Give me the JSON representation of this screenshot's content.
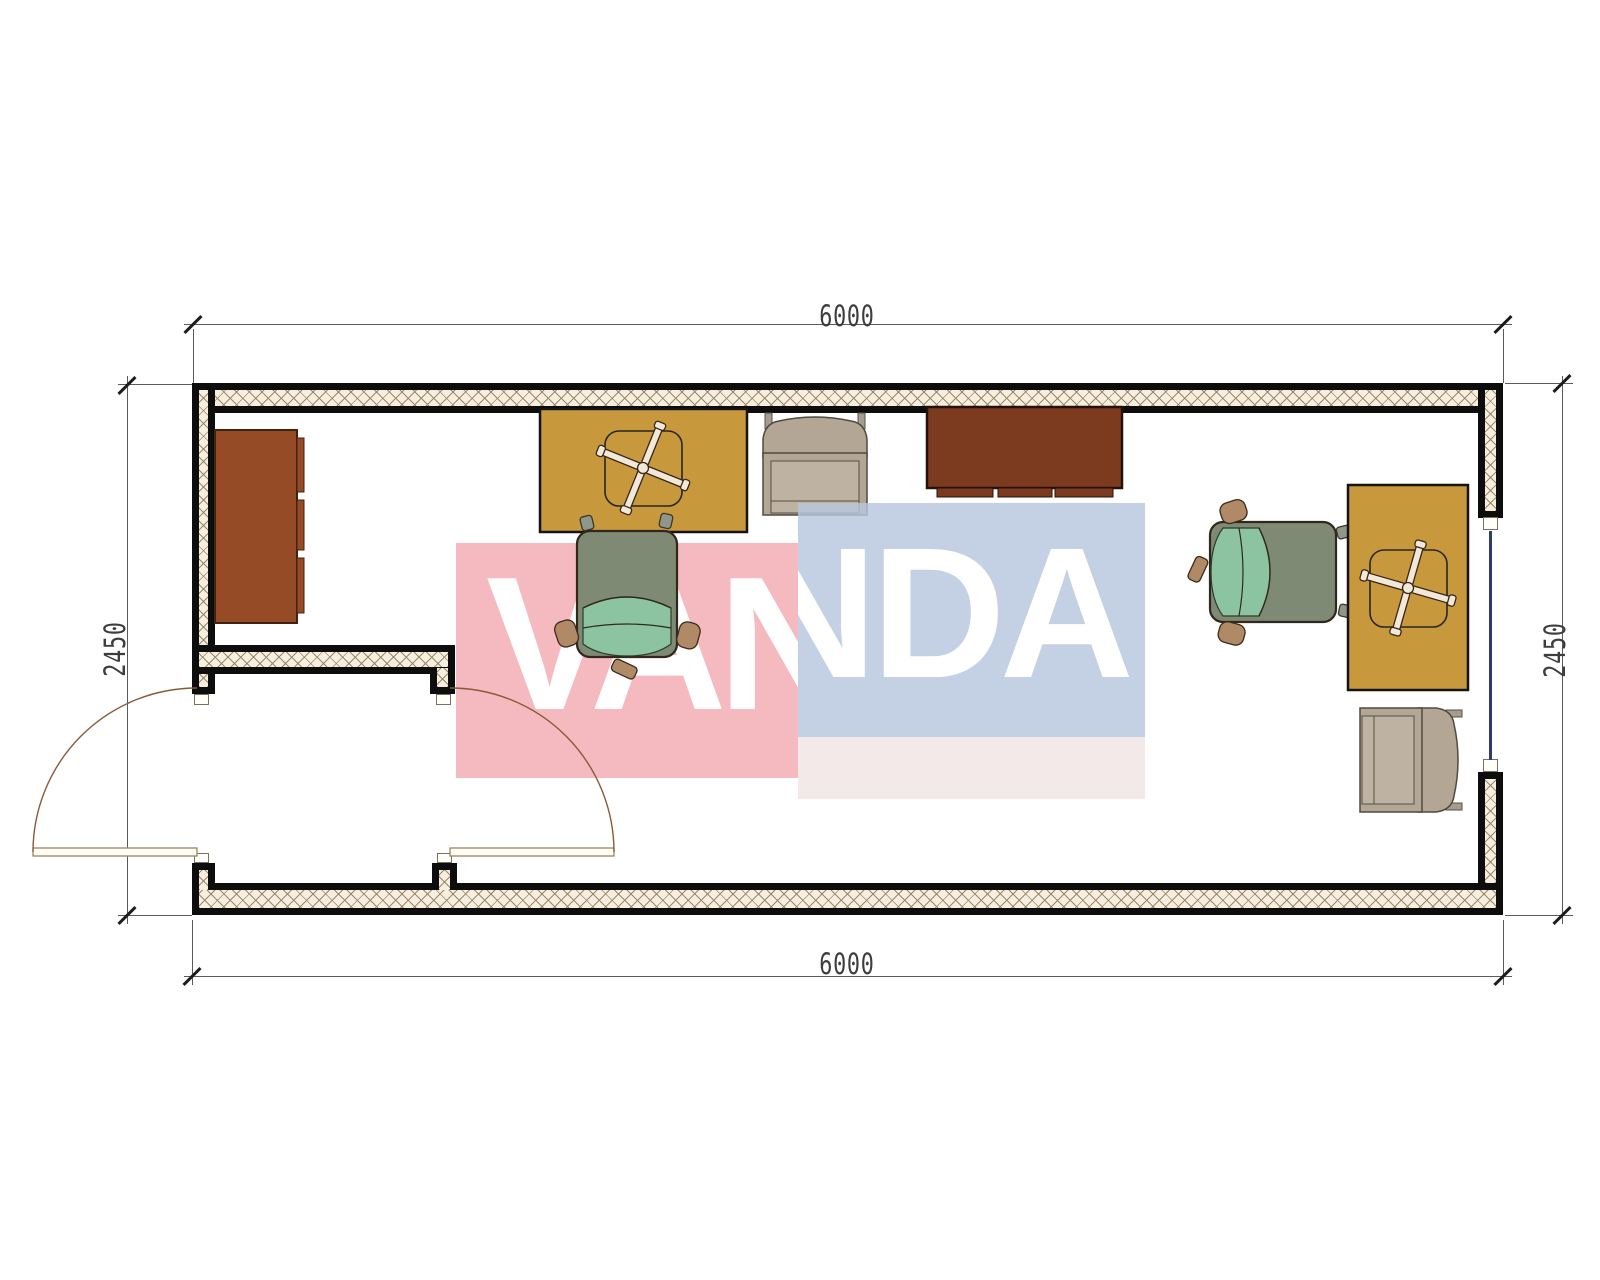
{
  "title": "Container office floor plan 6000 x 2450",
  "dimensions": {
    "top": "6000",
    "bottom": "6000",
    "left": "2450",
    "right": "2450"
  },
  "watermark": {
    "text": "VANDA",
    "part_pink": "VAN",
    "part_blue": "NDA",
    "pink_color": "#f6c9ce",
    "blue_color": "#ccd8e7",
    "text_color": "#ffffff"
  },
  "plan": {
    "wall_fill": "#f6efdf",
    "wall_edge": "#0d0d0d",
    "hatch_color": "#96826a",
    "window_glass_color": "#2e3d6b",
    "door_swing_color": "#8a5a36"
  },
  "furniture": {
    "cabinet": {
      "name": "wardrobe-cabinet",
      "color": "#954b26"
    },
    "desk_1": {
      "name": "desk-top-wall",
      "color": "#c8993c"
    },
    "desk_2": {
      "name": "desk-right-wall",
      "color": "#c8993c"
    },
    "sideboard": {
      "name": "sideboard",
      "color": "#7c3a1e"
    },
    "office_chair_1": {
      "name": "office-chair-center",
      "back_color": "#7e8a74",
      "seat_color": "#8cc4a2"
    },
    "office_chair_2": {
      "name": "office-chair-right",
      "back_color": "#7e8a74",
      "seat_color": "#8cc4a2"
    },
    "armchair_1": {
      "name": "armchair-top",
      "color": "#b3a695"
    },
    "armchair_2": {
      "name": "armchair-bottom-right",
      "color": "#b3a695"
    }
  }
}
